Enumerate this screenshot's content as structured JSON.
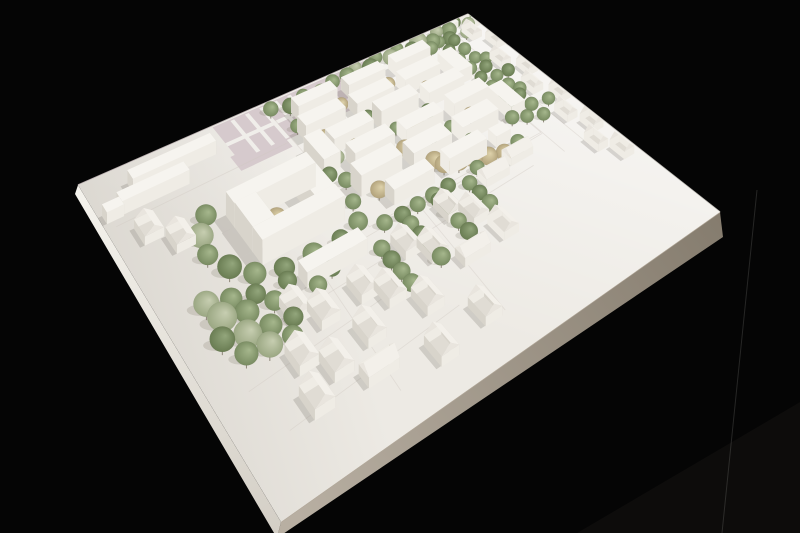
{
  "scene": {
    "alt": "white architectural massing model photographed from a corner angle on a black background",
    "background": {
      "base": "#050505",
      "corner_glow": "#0d0c0b",
      "artifact_line": "rgba(210,210,205,0.16)"
    },
    "board": {
      "corners": {
        "L": [
          78,
          185
        ],
        "T": [
          468,
          14
        ],
        "R": [
          720,
          212
        ],
        "B": [
          281,
          522
        ]
      },
      "top_fill": "#edeae4",
      "light_from": "#ffffff",
      "shade_tint": "rgba(108,100,88,0.14)",
      "edge_left": {
        "from": "#f4f2ec",
        "to": "#d2cdc4",
        "off1": [
          -3,
          9
        ],
        "off2": [
          -4,
          16
        ]
      },
      "edge_right": {
        "from": "#b8afa2",
        "to": "#857c6e",
        "off1": [
          -4,
          16
        ],
        "off2": [
          3,
          25
        ]
      },
      "edge_hairline": "#b3a99b",
      "far_edge_left": "#e6d9da",
      "far_edge_right": "#e9e5de"
    },
    "palette": {
      "bld_top": "#f6f4ef",
      "bld_front": "#efece5",
      "bld_side": "#d8d4cb",
      "roof_lit": "#f3f0ea",
      "roof_dark": "#e0dcd4",
      "gable_end": "#e9e5de",
      "shadow": "rgba(92,86,74,0.20)",
      "tree_shadow": "rgba(92,86,74,0.17)",
      "stem": "#8d8678",
      "field_fill": "#d6cacd",
      "field_stripe": "#f0eeea",
      "parcel_line": "#cfc9c0",
      "park_path": "#fafaf7",
      "plate_fill": "#e9e6df",
      "plate_rung": "#b9b4aa",
      "tree_gradients": {
        "g1": [
          "#a6b78d",
          "#75885e"
        ],
        "g2": [
          "#93a67c",
          "#66794f"
        ],
        "sage": [
          "#c7ceb1",
          "#97a47f"
        ],
        "beige": [
          "#ded2ab",
          "#af9f78"
        ]
      }
    },
    "gable_heights": {
      "wall": 2.0,
      "ridge": 3.5
    },
    "field": {
      "main": [
        29,
        0.5,
        39,
        15.5
      ],
      "patch": [
        28,
        13,
        12,
        6
      ],
      "stripes_u": [
        33,
        36.5,
        40,
        43.5,
        47,
        50.5
      ],
      "stripe_w": 0.9,
      "stripe_v": [
        1,
        15.5
      ],
      "band": [
        29,
        7.8,
        22,
        1.4
      ]
    },
    "park_path_pts": [
      [
        69,
        6.5
      ],
      [
        73,
        3
      ],
      [
        78,
        5
      ],
      [
        82,
        1.5
      ],
      [
        87,
        3
      ],
      [
        90,
        1
      ]
    ],
    "parcel_lines": [
      [
        [
          41,
          5
        ],
        [
          86,
          5
        ],
        [
          86,
          53
        ],
        [
          41,
          53
        ],
        [
          41,
          5
        ]
      ],
      [
        [
          86.2,
          0
        ],
        [
          86.2,
          62
        ]
      ],
      [
        [
          92,
          0
        ],
        [
          92,
          64
        ]
      ],
      [
        [
          8,
          56
        ],
        [
          44,
          55
        ],
        [
          86,
          53.5
        ]
      ],
      [
        [
          12,
          64
        ],
        [
          78,
          61
        ]
      ],
      [
        [
          28,
          56
        ],
        [
          26,
          92
        ]
      ],
      [
        [
          52,
          55
        ],
        [
          50,
          90
        ]
      ],
      [
        [
          2,
          18
        ],
        [
          40,
          17
        ]
      ],
      [
        [
          6,
          74
        ],
        [
          40,
          71
        ]
      ],
      [
        [
          8,
          86
        ],
        [
          44,
          83
        ]
      ]
    ],
    "plates": [
      [
        55,
        20.3,
        6,
        1.6
      ],
      [
        59.5,
        28.3,
        6,
        1.6
      ],
      [
        50,
        36.3,
        6,
        1.6
      ],
      [
        63,
        44.3,
        6,
        1.6
      ],
      [
        46,
        12.3,
        5,
        1.5
      ]
    ],
    "flats": [
      [
        8,
        6.5,
        18,
        3.5,
        3.2
      ],
      [
        4,
        12,
        14,
        3.5,
        3.2
      ],
      [
        0.8,
        13,
        3.4,
        3,
        2.6
      ],
      [
        20,
        30,
        18,
        4.5,
        5.6
      ],
      [
        20,
        43.5,
        18,
        4.5,
        5.6
      ],
      [
        20,
        34.5,
        4.5,
        9,
        5.6
      ],
      [
        33.5,
        34.5,
        4.5,
        9,
        5.6
      ],
      [
        45,
        7.5,
        10,
        4,
        4
      ],
      [
        58,
        7.5,
        10,
        4,
        3.6
      ],
      [
        71,
        7.5,
        10,
        4,
        4
      ],
      [
        43,
        15,
        10,
        4.5,
        4.2
      ],
      [
        56,
        15,
        10,
        4.5,
        3.8
      ],
      [
        69,
        15,
        10,
        4.5,
        4.2
      ],
      [
        81,
        15,
        4,
        10,
        4
      ],
      [
        41,
        22.5,
        4,
        10,
        4
      ],
      [
        46,
        23,
        10,
        4.5,
        3.8
      ],
      [
        58,
        23,
        10,
        4.5,
        5.2
      ],
      [
        71,
        23,
        10,
        4.5,
        4
      ],
      [
        47,
        31,
        10,
        4.5,
        4.2
      ],
      [
        60,
        31,
        10,
        4.5,
        3.8
      ],
      [
        73,
        31,
        10,
        4.5,
        4.4
      ],
      [
        44,
        39,
        10,
        5,
        5.2
      ],
      [
        57,
        39,
        10,
        5,
        4
      ],
      [
        70,
        39,
        10,
        5,
        4.2
      ],
      [
        83,
        35,
        4,
        10,
        4
      ],
      [
        48,
        47,
        10,
        4,
        3.8
      ],
      [
        62,
        47,
        10,
        4,
        4.2
      ],
      [
        75,
        47,
        4,
        3.5,
        3
      ],
      [
        24,
        55.5,
        13,
        4,
        3.4
      ],
      [
        95,
        0.5,
        3.5,
        2.5,
        2.4
      ],
      [
        91.5,
        1.5,
        3,
        2.2,
        2
      ],
      [
        98,
        4.5,
        2.5,
        2,
        2.2
      ]
    ],
    "gables": [
      [
        4.5,
        21,
        3.8,
        6.2,
        "v"
      ],
      [
        8.5,
        27.5,
        3.8,
        6.2,
        "v"
      ],
      [
        18,
        60,
        3.8,
        6.2,
        "v"
      ],
      [
        21.5,
        64.5,
        3.8,
        6.2,
        "v"
      ],
      [
        30,
        64,
        3.8,
        6.2,
        "v"
      ],
      [
        33.5,
        68.5,
        3.8,
        6.2,
        "v"
      ],
      [
        42,
        60,
        3.8,
        6.2,
        "v"
      ],
      [
        45.5,
        64.5,
        3.8,
        6.2,
        "v"
      ],
      [
        54,
        57,
        3.8,
        6.2,
        "v"
      ],
      [
        57.5,
        61.5,
        3.8,
        6.2,
        "v"
      ],
      [
        66,
        56,
        6.2,
        3.8,
        "u"
      ],
      [
        74,
        54,
        6.2,
        3.8,
        "u"
      ],
      [
        26,
        74,
        3.8,
        6.2,
        "v"
      ],
      [
        38,
        75,
        3.8,
        6.2,
        "v"
      ],
      [
        50,
        72,
        6.2,
        3.8,
        "u"
      ],
      [
        60,
        69,
        3.8,
        6.2,
        "v"
      ],
      [
        14,
        71,
        3.8,
        6.2,
        "v"
      ],
      [
        18,
        76.5,
        3.8,
        6.2,
        "v"
      ],
      [
        22,
        84,
        6.2,
        3.8,
        "u"
      ],
      [
        34,
        86.5,
        3.8,
        6.2,
        "v"
      ],
      [
        45,
        84.5,
        3.8,
        6.2,
        "v"
      ],
      [
        12,
        81,
        3.8,
        6.2,
        "v"
      ],
      [
        94,
        6,
        3,
        5.4,
        "v"
      ],
      [
        97,
        13,
        3,
        5.4,
        "v"
      ],
      [
        93,
        21,
        3,
        5.4,
        "v"
      ],
      [
        96.5,
        28,
        3,
        5.4,
        "v"
      ],
      [
        93,
        35,
        3,
        5.4,
        "v"
      ],
      [
        96.5,
        42,
        3,
        5.4,
        "v"
      ],
      [
        93,
        49,
        3,
        5.4,
        "v"
      ],
      [
        95.5,
        56,
        3,
        5.4,
        "v"
      ],
      [
        92,
        62,
        3,
        5.4,
        "v"
      ],
      [
        95,
        68,
        3,
        5.4,
        "v"
      ]
    ],
    "trees": [
      [
        62,
        3,
        2.6,
        "g1"
      ],
      [
        65,
        1.5,
        2.2,
        "sage"
      ],
      [
        68,
        4,
        3,
        "g2"
      ],
      [
        71,
        1,
        2.4,
        "g1"
      ],
      [
        74,
        3.5,
        2.8,
        "sage"
      ],
      [
        77,
        1.5,
        2.3,
        "g1"
      ],
      [
        80,
        4,
        2.6,
        "g2"
      ],
      [
        83,
        2,
        3.2,
        "sage"
      ],
      [
        86,
        4.5,
        2.7,
        "g1"
      ],
      [
        89,
        1.5,
        2.4,
        "sage"
      ],
      [
        92,
        3,
        2.8,
        "g1"
      ],
      [
        95,
        1,
        2.3,
        "g2"
      ],
      [
        97.5,
        4,
        2.5,
        "sage"
      ],
      [
        99,
        1.5,
        2.2,
        "g1"
      ],
      [
        84,
        7,
        2.4,
        "g1"
      ],
      [
        90,
        6.5,
        2.6,
        "g2"
      ],
      [
        95,
        7,
        2.3,
        "sage"
      ],
      [
        63,
        7,
        2.8,
        "sage"
      ],
      [
        67,
        6.5,
        2.2,
        "g1"
      ],
      [
        42,
        3,
        2.4,
        "g1"
      ],
      [
        46,
        5,
        2.6,
        "g2"
      ],
      [
        50,
        3.5,
        2.3,
        "g1"
      ],
      [
        54,
        5,
        2.7,
        "sage"
      ],
      [
        58,
        3,
        2.4,
        "g1"
      ],
      [
        52,
        13,
        2.6,
        "beige"
      ],
      [
        55.5,
        12.5,
        2.2,
        "beige"
      ],
      [
        47,
        21,
        2.5,
        "beige"
      ],
      [
        63,
        20.5,
        2.8,
        "beige"
      ],
      [
        51,
        28.5,
        2.4,
        "beige"
      ],
      [
        66,
        29,
        3,
        "beige"
      ],
      [
        59,
        36.5,
        2.6,
        "beige"
      ],
      [
        48,
        44.5,
        2.5,
        "beige"
      ],
      [
        62,
        44.5,
        2.7,
        "beige"
      ],
      [
        74.5,
        20.5,
        2.3,
        "beige"
      ],
      [
        77,
        36.5,
        2.5,
        "beige"
      ],
      [
        68,
        13,
        2.3,
        "beige"
      ],
      [
        44,
        13,
        2.2,
        "g1"
      ],
      [
        58,
        21,
        2.3,
        "g2"
      ],
      [
        54,
        29,
        2.2,
        "g1"
      ],
      [
        70,
        28.5,
        2.4,
        "g2"
      ],
      [
        44,
        37,
        2.3,
        "g1"
      ],
      [
        57,
        45,
        2.2,
        "g2"
      ],
      [
        72,
        44.5,
        2.4,
        "g1"
      ],
      [
        66,
        37,
        2.2,
        "g2"
      ],
      [
        50,
        21,
        2,
        "g1"
      ],
      [
        61,
        29,
        2,
        "g1"
      ],
      [
        46,
        29,
        2.1,
        "sage"
      ],
      [
        53,
        37,
        2.2,
        "g1"
      ],
      [
        65,
        13,
        2.1,
        "g1"
      ],
      [
        71,
        37,
        2,
        "g1"
      ],
      [
        79,
        13,
        2.2,
        "g1"
      ],
      [
        82,
        21,
        2.1,
        "g2"
      ],
      [
        80,
        29,
        2.2,
        "g1"
      ],
      [
        84,
        44,
        2.3,
        "g1"
      ],
      [
        87,
        6,
        2.2,
        "g1"
      ],
      [
        87,
        11,
        2.3,
        "g2"
      ],
      [
        87,
        16,
        2.2,
        "g1"
      ],
      [
        87,
        21,
        2.4,
        "g1"
      ],
      [
        87,
        26,
        2.2,
        "g2"
      ],
      [
        87,
        31,
        2.3,
        "g1"
      ],
      [
        87,
        36,
        2.2,
        "g1"
      ],
      [
        87,
        41,
        2.4,
        "g2"
      ],
      [
        87,
        46,
        2.2,
        "g1"
      ],
      [
        90.5,
        8,
        2.2,
        "g2"
      ],
      [
        90.5,
        13,
        2.3,
        "g1"
      ],
      [
        90.5,
        18,
        2.2,
        "g1"
      ],
      [
        90.5,
        23,
        2.3,
        "g2"
      ],
      [
        90.5,
        28,
        2.2,
        "g1"
      ],
      [
        90.5,
        33,
        2.4,
        "g1"
      ],
      [
        90.5,
        38,
        2.2,
        "g2"
      ],
      [
        90.5,
        43,
        2.3,
        "g1"
      ],
      [
        90.5,
        48,
        2.2,
        "g1"
      ],
      [
        17,
        27,
        2.8,
        "g1"
      ],
      [
        14,
        32,
        3.2,
        "sage"
      ],
      [
        13,
        38,
        2.6,
        "g1"
      ],
      [
        15,
        44,
        3,
        "g2"
      ],
      [
        18,
        49,
        2.8,
        "g1"
      ],
      [
        23,
        51.5,
        2.6,
        "g2"
      ],
      [
        29,
        52,
        2.8,
        "g1"
      ],
      [
        35,
        52,
        2.4,
        "g2"
      ],
      [
        40,
        50,
        2.6,
        "g1"
      ],
      [
        42,
        44,
        2.2,
        "g1"
      ],
      [
        42,
        33,
        2.3,
        "g2"
      ],
      [
        41,
        27,
        2.2,
        "g1"
      ],
      [
        35,
        27.5,
        2.5,
        "g2"
      ],
      [
        28,
        27,
        2.3,
        "g1"
      ],
      [
        27.8,
        37.5,
        2.6,
        "beige"
      ],
      [
        29.3,
        40.8,
        3,
        "beige"
      ],
      [
        8,
        50,
        3,
        "sage"
      ],
      [
        12,
        52,
        2.6,
        "g1"
      ],
      [
        16,
        54,
        2.4,
        "g2"
      ],
      [
        9,
        55,
        3.4,
        "sage"
      ],
      [
        13,
        57,
        2.8,
        "g1"
      ],
      [
        18,
        58,
        2.4,
        "g1"
      ],
      [
        7,
        60,
        2.8,
        "g2"
      ],
      [
        11,
        62,
        3.2,
        "sage"
      ],
      [
        15,
        63,
        2.6,
        "g1"
      ],
      [
        19,
        64,
        2.3,
        "g2"
      ],
      [
        9,
        66,
        2.6,
        "g1"
      ],
      [
        13,
        67,
        2.9,
        "sage"
      ],
      [
        17,
        68,
        2.4,
        "g1"
      ],
      [
        21,
        60,
        2.2,
        "g1"
      ],
      [
        22,
        55,
        2.3,
        "g2"
      ],
      [
        44,
        54,
        2.2,
        "g1"
      ],
      [
        48,
        54.5,
        2.3,
        "g2"
      ],
      [
        52,
        54,
        2.2,
        "g1"
      ],
      [
        56,
        54,
        2.4,
        "g1"
      ],
      [
        60,
        53.5,
        2.2,
        "g2"
      ],
      [
        68,
        53,
        2.2,
        "g1"
      ],
      [
        80,
        52,
        2.3,
        "g1"
      ],
      [
        48,
        58,
        2.2,
        "g1"
      ],
      [
        48,
        62,
        2.3,
        "g2"
      ],
      [
        48,
        66,
        2.2,
        "g1"
      ],
      [
        48,
        70,
        2.4,
        "g1"
      ],
      [
        56,
        56,
        2.2,
        "g2"
      ],
      [
        56,
        60,
        2.3,
        "g1"
      ],
      [
        56,
        64,
        2.2,
        "g1"
      ],
      [
        56,
        68,
        2.4,
        "g2"
      ],
      [
        64,
        56,
        2.2,
        "g1"
      ],
      [
        64,
        60,
        2.2,
        "g2"
      ],
      [
        64,
        64,
        2.3,
        "g1"
      ],
      [
        40,
        60,
        2.2,
        "g1"
      ],
      [
        40,
        64,
        2.3,
        "g2"
      ],
      [
        40,
        68,
        2.2,
        "g1"
      ],
      [
        40,
        72,
        2.3,
        "g1"
      ],
      [
        92.5,
        20,
        2.2,
        "g1"
      ],
      [
        94,
        28,
        2.3,
        "g2"
      ],
      [
        92,
        36,
        2.2,
        "g1"
      ],
      [
        95,
        44,
        2.2,
        "g1"
      ],
      [
        63,
        47,
        2.7,
        "beige"
      ],
      [
        66,
        48.5,
        2.8,
        "beige"
      ],
      [
        69,
        50,
        2.6,
        "beige"
      ],
      [
        72,
        51.5,
        2.8,
        "beige"
      ],
      [
        75.5,
        53,
        2.6,
        "beige"
      ],
      [
        26,
        60,
        2.2,
        "g1"
      ],
      [
        30,
        58,
        2.1,
        "g2"
      ]
    ]
  }
}
